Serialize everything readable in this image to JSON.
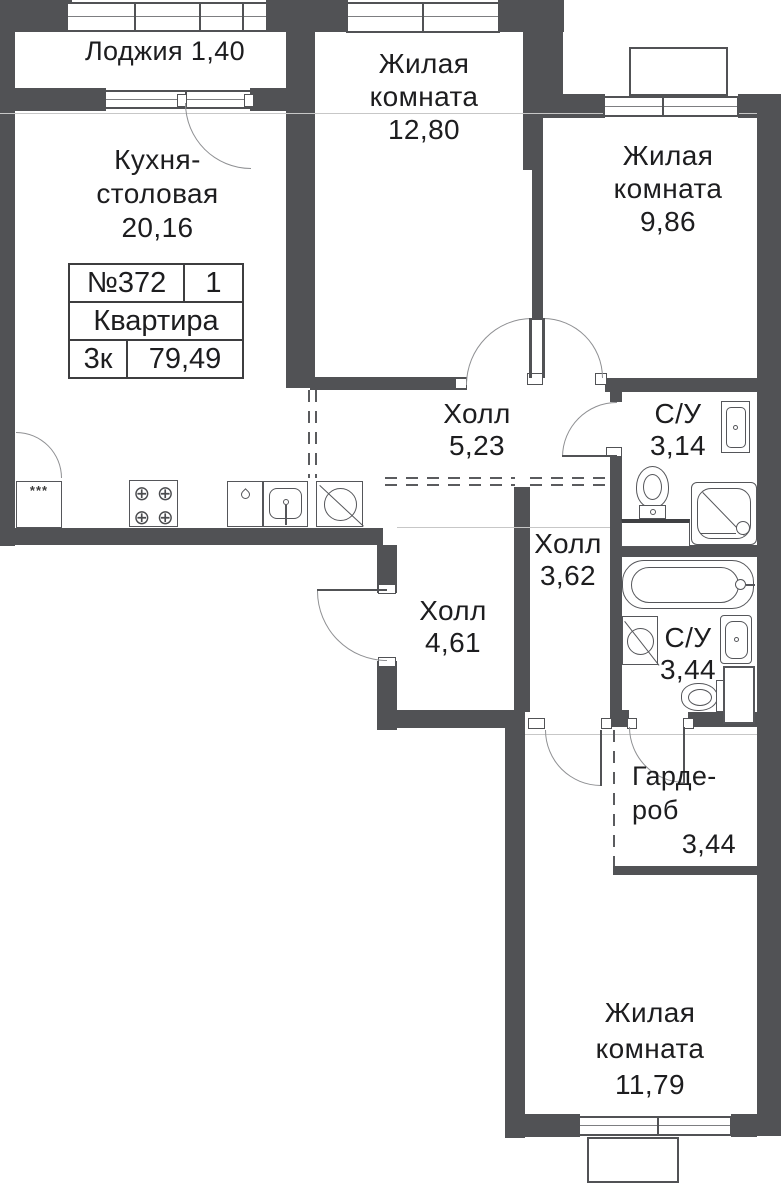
{
  "info_box": {
    "number": "№372",
    "section": "1",
    "type_label": "Квартира",
    "rooms_count": "3к",
    "total_area": "79,49"
  },
  "rooms": {
    "loggia": {
      "name": "Лоджия",
      "area": "1,40"
    },
    "kitchen": {
      "line1": "Кухня-",
      "line2": "столовая",
      "area": "20,16"
    },
    "living_top": {
      "line1": "Жилая",
      "line2": "комната",
      "area": "12,80"
    },
    "living_right": {
      "line1": "Жилая",
      "line2": "комната",
      "area": "9,86"
    },
    "hall_main": {
      "name": "Холл",
      "area": "5,23"
    },
    "bath_small": {
      "name": "С/У",
      "area": "3,14"
    },
    "hall_middle": {
      "name": "Холл",
      "area": "3,62"
    },
    "hall_lower": {
      "name": "Холл",
      "area": "4,61"
    },
    "bath_big": {
      "name": "С/У",
      "area": "3,44"
    },
    "wardrobe": {
      "line1": "Гарде-",
      "line2": "роб",
      "area": "3,44"
    },
    "living_bottom": {
      "line1": "Жилая",
      "line2": "комната",
      "area": "11,79"
    }
  },
  "fixtures": {
    "fridge_symbol": "***",
    "burner_symbol": "⊕"
  },
  "colors": {
    "wall": "#515255",
    "door_arc": "#8f9093",
    "text": "#1d1d1f"
  }
}
